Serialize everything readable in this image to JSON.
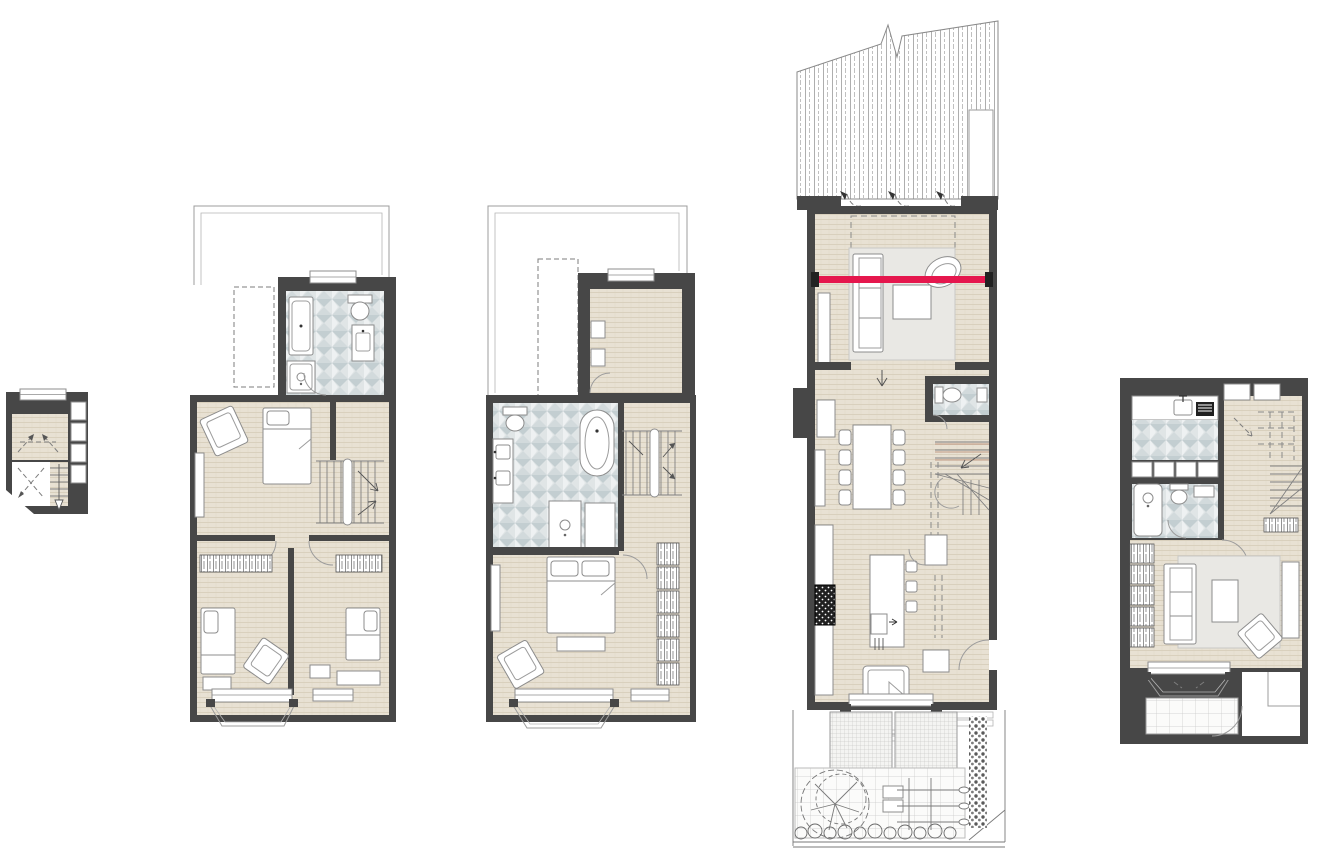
{
  "document": {
    "type": "architectural-floor-plan-sheet",
    "description": "Five townhouse floor plans drawn side by side on a white sheet",
    "visible_text": "none"
  },
  "palette": {
    "wall": "#474747",
    "wood": "#e8e1d3",
    "wood_line": "#d6ccb8",
    "tile_bg": "#e0e5e6",
    "tile_fg": "#c3ced1",
    "tile_fg2": "#d2dadc",
    "rug": "#e9e8e4",
    "line": "#8c8c8c",
    "thin": "#9c9c9c",
    "beam": "#e5174d",
    "appliance": "#202020",
    "stair_accent": "#b5826b",
    "paper": "#ffffff"
  },
  "plans": [
    {
      "id": "plan-a",
      "label": "loft-plan",
      "rooms": [
        "loft-room",
        "eaves-void",
        "stair"
      ],
      "features": [
        "window",
        "shelving-column",
        "dashed-headroom-arrows"
      ]
    },
    {
      "id": "plan-b",
      "label": "second-floor-plan",
      "rooms": [
        "roof-terrace-outline",
        "bathroom",
        "bedroom",
        "landing-stair",
        "hallway",
        "bedroom-2",
        "bedroom-3"
      ],
      "furniture": [
        "bathtub",
        "shower",
        "toilet",
        "vanity-basin",
        "single-bed",
        "armchair",
        "built-in-wardrobes",
        "single-bed-2",
        "armchair-2",
        "bay-window",
        "skylight-dashed"
      ]
    },
    {
      "id": "plan-c",
      "label": "first-floor-plan",
      "rooms": [
        "roof-terrace-outline",
        "study",
        "bathroom",
        "landing-stair",
        "master-bedroom"
      ],
      "furniture": [
        "freestanding-bath",
        "double-vanity",
        "toilet",
        "shower",
        "cupboard",
        "desk",
        "double-bed",
        "foot-bench",
        "armchair",
        "wardrobe-run",
        "bay-window",
        "skylight-dashed"
      ]
    },
    {
      "id": "plan-d",
      "label": "ground-floor-plan",
      "rooms": [
        "glazed-roof-extension",
        "living-area",
        "dining-area",
        "wc",
        "stair",
        "kitchen",
        "bay-window-seat",
        "entrance",
        "garden"
      ],
      "furniture": [
        "sofa",
        "rug",
        "coffee-table",
        "swivel-chair",
        "dining-table-8-chairs",
        "sideboard",
        "toilet",
        "basin",
        "kitchen-island",
        "bar-stools",
        "range-cooker",
        "larder",
        "window-seat",
        "patio-grids",
        "tree",
        "raised-beds",
        "espalier-plants",
        "hedge",
        "planting-row"
      ],
      "annotations": [
        "red-section-beam",
        "bifold-door-swing-arrows",
        "dashed-roof-over-outline",
        "break-line-in-glazed-roof"
      ]
    },
    {
      "id": "plan-e",
      "label": "lower-ground-floor-plan",
      "rooms": [
        "utility",
        "shower-room",
        "hall-stair",
        "snug",
        "bay-window",
        "lightwell",
        "entrance-court"
      ],
      "furniture": [
        "worktop-sink",
        "dark-appliance",
        "storage-units",
        "shower-tray",
        "toilet",
        "basin",
        "bookshelf-run",
        "sofa",
        "rug",
        "coffee-table",
        "armchair",
        "media-unit",
        "door-mat"
      ]
    }
  ]
}
